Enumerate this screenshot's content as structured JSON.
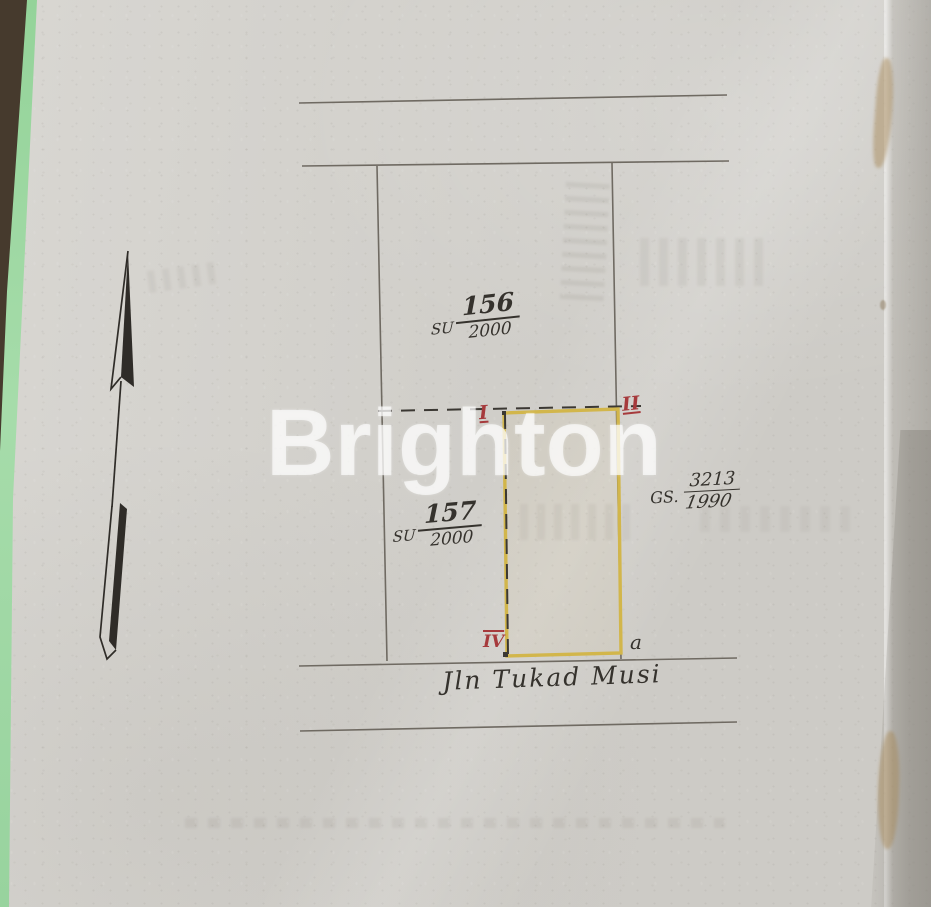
{
  "watermark": {
    "text": "Brighton"
  },
  "north_arrow": {
    "icon": "north-arrow-icon"
  },
  "parcels": [
    {
      "prefix": "SU",
      "number": "156",
      "denominator": "2000"
    },
    {
      "prefix": "SU",
      "number": "157",
      "denominator": "2000"
    }
  ],
  "reference": {
    "prefix": "GS.",
    "number": "3213",
    "year": "1990"
  },
  "corners": {
    "top_left": "I",
    "top_right": "II",
    "bottom_left": "IV",
    "bottom_right": "a"
  },
  "street": {
    "label": "Jln Tukad Musi"
  },
  "colors": {
    "paper": "#d5d3ce",
    "pencil": "#6f6a62",
    "ink": "#35322d",
    "plot_yellow": "#d2b64b",
    "corner_red": "#a63a3c",
    "edge_green": "#98d69c",
    "edge_brown": "#463a2d"
  }
}
